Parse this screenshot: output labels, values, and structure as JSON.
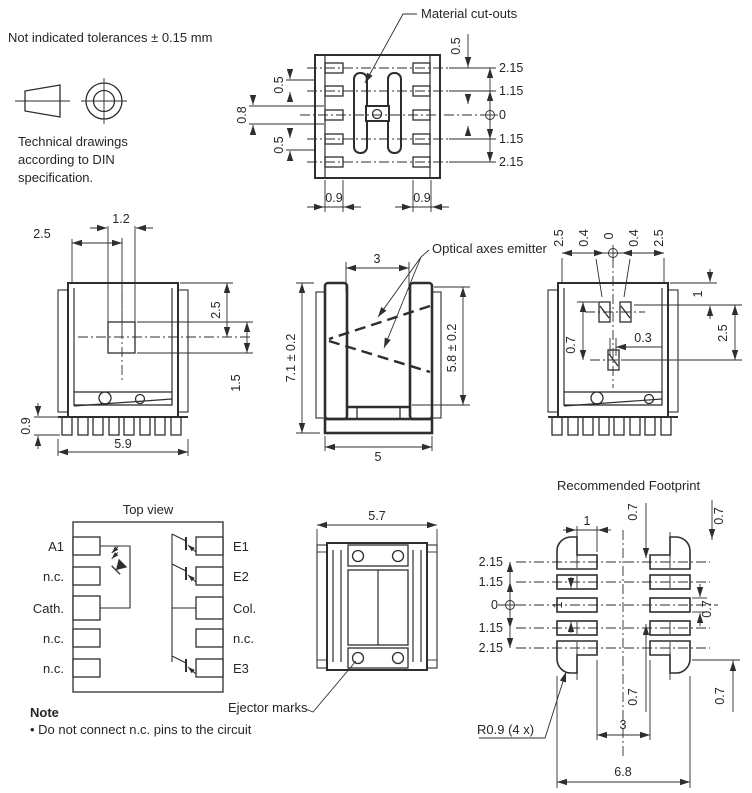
{
  "header": {
    "tolerance_note": "Not indicated tolerances ± 0.15 mm",
    "din_note_line1": "Technical drawings",
    "din_note_line2": "according to DIN",
    "din_note_line3": "specification."
  },
  "callouts": {
    "material_cutouts": "Material cut-outs",
    "optical_axes_emitter": "Optical axes emitter",
    "ejector_marks": "Ejector marks",
    "footprint_radius": "R0.9 (4 x)"
  },
  "note": {
    "title": "Note",
    "text": "• Do not connect n.c. pins to the circuit"
  },
  "views": {
    "top_outline": {
      "dims": {
        "left_upper": "0.5",
        "left_center": "0.8",
        "left_lower": "0.5",
        "top_right": "0.5",
        "right": [
          "2.15",
          "1.15",
          "0",
          "1.15",
          "2.15"
        ],
        "bottom_left": "0.9",
        "bottom_right": "0.9"
      }
    },
    "front": {
      "dims": {
        "window_width": "1.2",
        "window_offset": "2.5",
        "top_to_center": "2.5",
        "center_to_base": "1.5",
        "lead_height": "0.9",
        "overall_width": "5.9"
      }
    },
    "side": {
      "dims": {
        "slot_width": "3",
        "overall_height": "7.1 ± 0.2",
        "inner_height": "5.8 ± 0.2",
        "overall_width": "5"
      }
    },
    "rear": {
      "dims": {
        "top": [
          "2.5",
          "0.4",
          "0",
          "0.4",
          "2.5"
        ],
        "edge_to_row": "1",
        "row_span": "2.5",
        "window_height": "0.7",
        "window_offset": "0.3"
      }
    },
    "pin_diagram": {
      "title": "Top view",
      "left_pins": [
        "A1",
        "n.c.",
        "Cath.",
        "n.c.",
        "n.c."
      ],
      "right_pins": [
        "E1",
        "E2",
        "Col.",
        "n.c.",
        "E3"
      ]
    },
    "bottom": {
      "dims": {
        "overall_width": "5.7"
      }
    },
    "footprint": {
      "title": "Recommended Footprint",
      "dims": {
        "pad_width": "1",
        "left": [
          "2.15",
          "1.15",
          "0",
          "1.15",
          "2.15"
        ],
        "row_pitch": "1",
        "top_center": "0.7",
        "top_right": "0.7",
        "pad_height": "0.7",
        "bottom_center": "0.7",
        "bottom_right": "0.7",
        "column_gap": "3",
        "overall_width": "6.8"
      }
    }
  }
}
